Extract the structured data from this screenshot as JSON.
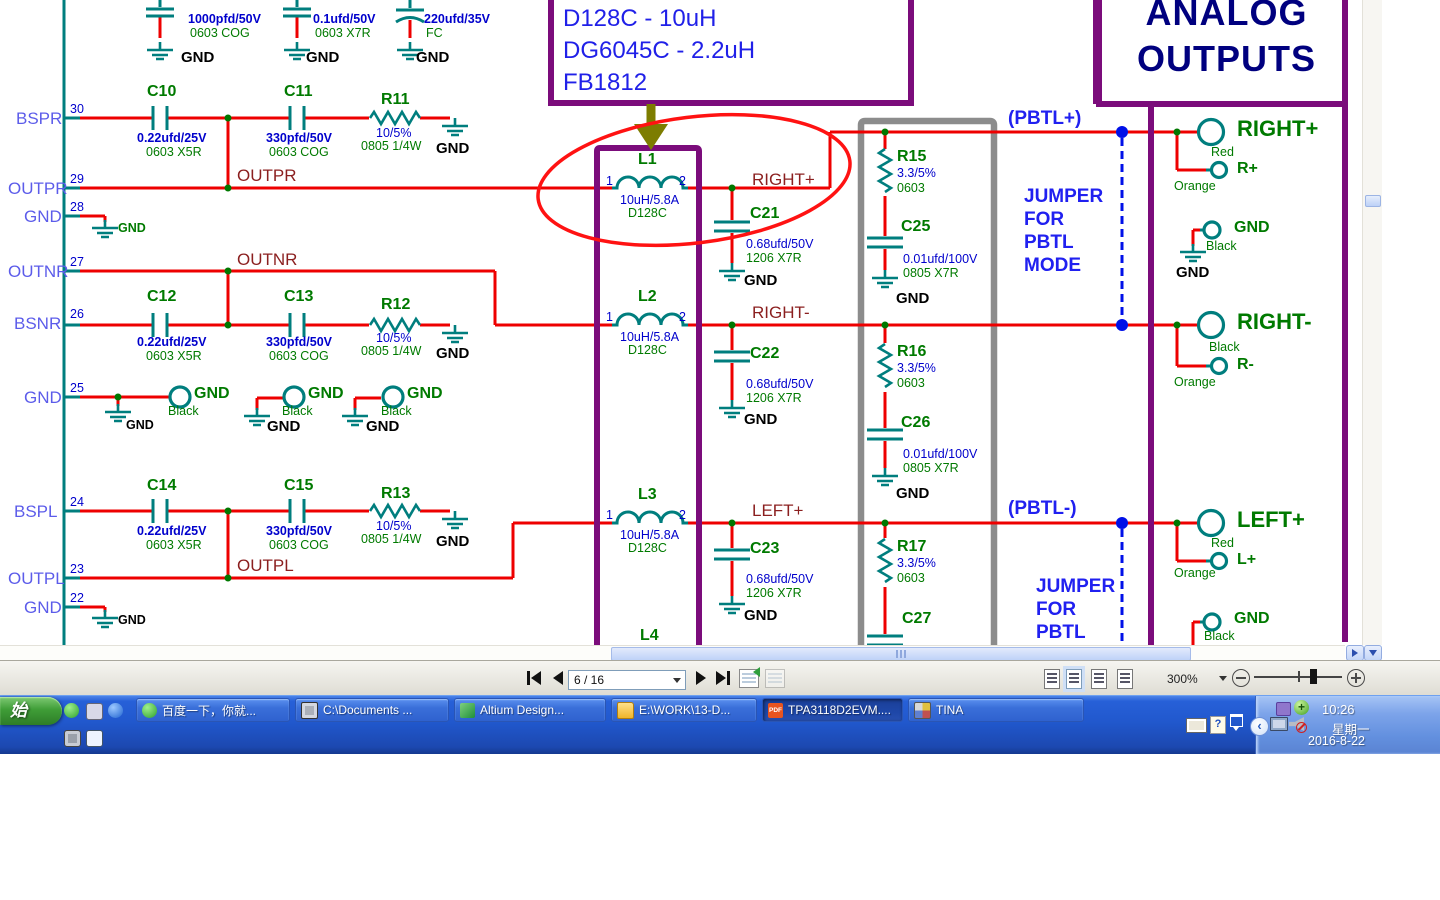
{
  "schematic": {
    "analog_title_line1": "ANALOG",
    "analog_title_line2": "OUTPUTS",
    "labels": [
      [
        188,
        13,
        "v",
        "1000pfd/50V"
      ],
      [
        190,
        27,
        "p",
        "0603  COG"
      ],
      [
        181,
        50,
        "gb",
        "GND"
      ],
      [
        313,
        13,
        "v",
        "0.1ufd/50V"
      ],
      [
        315,
        27,
        "p",
        "0603  X7R"
      ],
      [
        306,
        50,
        "gb",
        "GND"
      ],
      [
        424,
        13,
        "v",
        "220ufd/35V"
      ],
      [
        426,
        27,
        "p",
        "FC"
      ],
      [
        416,
        50,
        "gb",
        "GND"
      ],
      [
        147,
        84,
        "d",
        "C10"
      ],
      [
        137,
        132,
        "v",
        "0.22ufd/25V"
      ],
      [
        146,
        146,
        "p",
        "0603 X5R"
      ],
      [
        284,
        84,
        "d",
        "C11"
      ],
      [
        266,
        132,
        "v",
        "330pfd/50V"
      ],
      [
        269,
        146,
        "p",
        "0603  COG"
      ],
      [
        381,
        92,
        "d",
        "R11"
      ],
      [
        376,
        127,
        "v2",
        "10/5%"
      ],
      [
        361,
        140,
        "p",
        "0805 1/4W"
      ],
      [
        436,
        141,
        "gb",
        "GND"
      ],
      [
        16,
        110,
        "pn",
        "BSPR"
      ],
      [
        70,
        103,
        "nm",
        "30"
      ],
      [
        8,
        180,
        "pn",
        "OUTPR"
      ],
      [
        70,
        173,
        "nm",
        "29"
      ],
      [
        237,
        167,
        "nl",
        "OUTPR"
      ],
      [
        24,
        208,
        "pn",
        "GND"
      ],
      [
        70,
        201,
        "nm",
        "28"
      ],
      [
        118,
        222,
        "gg",
        "GND"
      ],
      [
        8,
        263,
        "pn",
        "OUTNR"
      ],
      [
        70,
        256,
        "nm",
        "27"
      ],
      [
        237,
        251,
        "nl",
        "OUTNR"
      ],
      [
        14,
        315,
        "pn",
        "BSNR"
      ],
      [
        70,
        308,
        "nm",
        "26"
      ],
      [
        147,
        289,
        "d",
        "C12"
      ],
      [
        137,
        336,
        "v",
        "0.22ufd/25V"
      ],
      [
        146,
        350,
        "p",
        "0603 X5R"
      ],
      [
        284,
        289,
        "d",
        "C13"
      ],
      [
        266,
        336,
        "v",
        "330pfd/50V"
      ],
      [
        269,
        350,
        "p",
        "0603  COG"
      ],
      [
        381,
        297,
        "d",
        "R12"
      ],
      [
        376,
        332,
        "v2",
        "10/5%"
      ],
      [
        361,
        345,
        "p",
        "0805 1/4W"
      ],
      [
        436,
        346,
        "gb",
        "GND"
      ],
      [
        24,
        389,
        "pn",
        "GND"
      ],
      [
        70,
        382,
        "nm",
        "25"
      ],
      [
        126,
        419,
        "gbs",
        "GND"
      ],
      [
        194,
        386,
        "cg",
        "GND"
      ],
      [
        168,
        405,
        "sg",
        "Black"
      ],
      [
        267,
        419,
        "gb",
        "GND"
      ],
      [
        308,
        386,
        "cg",
        "GND"
      ],
      [
        282,
        405,
        "sg",
        "Black"
      ],
      [
        366,
        419,
        "gb",
        "GND"
      ],
      [
        407,
        386,
        "cg",
        "GND"
      ],
      [
        381,
        405,
        "sg",
        "Black"
      ],
      [
        14,
        503,
        "pn",
        "BSPL"
      ],
      [
        70,
        496,
        "nm",
        "24"
      ],
      [
        147,
        478,
        "d",
        "C14"
      ],
      [
        137,
        525,
        "v",
        "0.22ufd/25V"
      ],
      [
        146,
        539,
        "p",
        "0603 X5R"
      ],
      [
        284,
        478,
        "d",
        "C15"
      ],
      [
        266,
        525,
        "v",
        "330pfd/50V"
      ],
      [
        269,
        539,
        "p",
        "0603  COG"
      ],
      [
        381,
        486,
        "d",
        "R13"
      ],
      [
        376,
        520,
        "v2",
        "10/5%"
      ],
      [
        361,
        533,
        "p",
        "0805 1/4W"
      ],
      [
        436,
        534,
        "gb",
        "GND"
      ],
      [
        8,
        570,
        "pn",
        "OUTPL"
      ],
      [
        70,
        563,
        "nm",
        "23"
      ],
      [
        237,
        557,
        "nl",
        "OUTPL"
      ],
      [
        24,
        599,
        "pn",
        "GND"
      ],
      [
        70,
        592,
        "nm",
        "22"
      ],
      [
        118,
        614,
        "gbs",
        "GND"
      ],
      [
        560,
        -21,
        "co",
        "TRIPLE FOOTPRINT PADS"
      ],
      [
        563,
        6,
        "co",
        "D128C - 10uH"
      ],
      [
        563,
        38,
        "co",
        "DG6045C - 2.2uH"
      ],
      [
        563,
        70,
        "co",
        "FB1812"
      ],
      [
        638,
        152,
        "d",
        "L1"
      ],
      [
        606,
        175,
        "nm",
        "1"
      ],
      [
        679,
        175,
        "nm",
        "2"
      ],
      [
        620,
        194,
        "v2",
        "10uH/5.8A"
      ],
      [
        628,
        207,
        "p",
        "D128C"
      ],
      [
        638,
        289,
        "d",
        "L2"
      ],
      [
        606,
        311,
        "nm",
        "1"
      ],
      [
        679,
        311,
        "nm",
        "2"
      ],
      [
        620,
        331,
        "v2",
        "10uH/5.8A"
      ],
      [
        628,
        344,
        "p",
        "D128C"
      ],
      [
        638,
        487,
        "d",
        "L3"
      ],
      [
        606,
        509,
        "nm",
        "1"
      ],
      [
        679,
        509,
        "nm",
        "2"
      ],
      [
        620,
        529,
        "v2",
        "10uH/5.8A"
      ],
      [
        628,
        542,
        "p",
        "D128C"
      ],
      [
        640,
        628,
        "d",
        "L4"
      ],
      [
        752,
        171,
        "nl",
        "RIGHT+"
      ],
      [
        752,
        304,
        "nl",
        "RIGHT-"
      ],
      [
        752,
        502,
        "nl",
        "LEFT+"
      ],
      [
        750,
        206,
        "d",
        "C21"
      ],
      [
        746,
        238,
        "v2",
        "0.68ufd/50V"
      ],
      [
        746,
        252,
        "p",
        "1206  X7R"
      ],
      [
        744,
        273,
        "gb",
        "GND"
      ],
      [
        750,
        346,
        "d",
        "C22"
      ],
      [
        746,
        378,
        "v2",
        "0.68ufd/50V"
      ],
      [
        746,
        392,
        "p",
        "1206  X7R"
      ],
      [
        744,
        412,
        "gb",
        "GND"
      ],
      [
        750,
        541,
        "d",
        "C23"
      ],
      [
        746,
        573,
        "v2",
        "0.68ufd/50V"
      ],
      [
        746,
        587,
        "p",
        "1206  X7R"
      ],
      [
        744,
        608,
        "gb",
        "GND"
      ],
      [
        897,
        149,
        "d",
        "R15"
      ],
      [
        897,
        167,
        "v2",
        "3.3/5%"
      ],
      [
        897,
        182,
        "p",
        "0603"
      ],
      [
        901,
        219,
        "d",
        "C25"
      ],
      [
        903,
        253,
        "v2",
        "0.01ufd/100V"
      ],
      [
        903,
        267,
        "p",
        "0805  X7R"
      ],
      [
        896,
        291,
        "gb",
        "GND"
      ],
      [
        897,
        344,
        "d",
        "R16"
      ],
      [
        897,
        362,
        "v2",
        "3.3/5%"
      ],
      [
        897,
        377,
        "p",
        "0603"
      ],
      [
        901,
        415,
        "d",
        "C26"
      ],
      [
        903,
        448,
        "v2",
        "0.01ufd/100V"
      ],
      [
        903,
        462,
        "p",
        "0805  X7R"
      ],
      [
        896,
        486,
        "gb",
        "GND"
      ],
      [
        897,
        539,
        "d",
        "R17"
      ],
      [
        897,
        557,
        "v2",
        "3.3/5%"
      ],
      [
        897,
        572,
        "p",
        "0603"
      ],
      [
        902,
        611,
        "d",
        "C27"
      ],
      [
        1008,
        109,
        "nb",
        "(PBTL+)"
      ],
      [
        1024,
        187,
        "nb",
        "JUMPER"
      ],
      [
        1024,
        210,
        "nb",
        "FOR"
      ],
      [
        1024,
        233,
        "nb",
        "PBTL"
      ],
      [
        1024,
        256,
        "nb",
        "MODE"
      ],
      [
        1008,
        499,
        "nb",
        "(PBTL-)"
      ],
      [
        1036,
        577,
        "nb",
        "JUMPER"
      ],
      [
        1036,
        600,
        "nb",
        "FOR"
      ],
      [
        1036,
        623,
        "nb",
        "PBTL"
      ],
      [
        1237,
        117,
        "bg",
        "RIGHT+"
      ],
      [
        1211,
        146,
        "sg",
        "Red"
      ],
      [
        1237,
        161,
        "cg",
        "R+"
      ],
      [
        1174,
        180,
        "sg",
        "Orange"
      ],
      [
        1234,
        220,
        "cg",
        "GND"
      ],
      [
        1206,
        240,
        "sg",
        "Black"
      ],
      [
        1176,
        265,
        "gb",
        "GND"
      ],
      [
        1237,
        310,
        "bg",
        "RIGHT-"
      ],
      [
        1209,
        341,
        "sg",
        "Black"
      ],
      [
        1237,
        357,
        "cg",
        "R-"
      ],
      [
        1174,
        376,
        "sg",
        "Orange"
      ],
      [
        1237,
        508,
        "bg",
        "LEFT+"
      ],
      [
        1211,
        537,
        "sg",
        "Red"
      ],
      [
        1237,
        552,
        "cg",
        "L+"
      ],
      [
        1174,
        567,
        "sg",
        "Orange"
      ],
      [
        1234,
        611,
        "cg",
        "GND"
      ],
      [
        1204,
        630,
        "sg",
        "Black"
      ]
    ]
  },
  "toolbar": {
    "page_indicator": "6 / 16",
    "zoom_level": "300%"
  },
  "taskbar": {
    "start_label": "始",
    "buttons": [
      {
        "label": "百度一下，你就...",
        "icon": "browser-green",
        "w": 154
      },
      {
        "label": "C:\\Documents ...",
        "icon": "chip",
        "w": 154
      },
      {
        "label": "Altium Design...",
        "icon": "altium",
        "w": 152
      },
      {
        "label": "E:\\WORK\\13-D...",
        "icon": "folder",
        "w": 146
      },
      {
        "label": "TPA3118D2EVM....",
        "icon": "pdf",
        "active": true,
        "w": 141
      },
      {
        "label": "TINA",
        "icon": "tina",
        "w": 176
      }
    ],
    "pdf_icon_text": "PDF",
    "tray": {
      "time": "10:26",
      "weekday": "星期一",
      "date": "2016-8-22"
    }
  }
}
